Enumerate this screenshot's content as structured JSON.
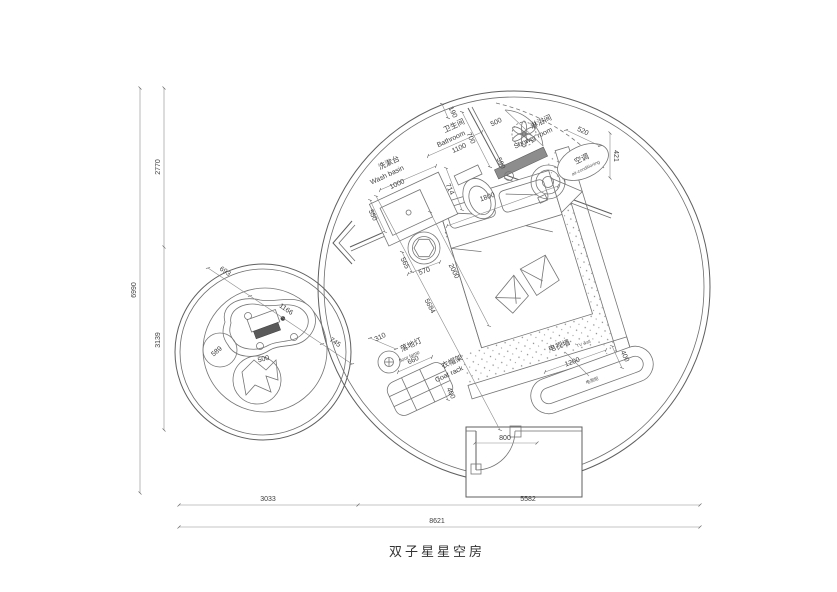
{
  "title": "双子星星空房",
  "dims": {
    "total_height": "6990",
    "upper_height": "2770",
    "lower_height": "3139",
    "left_width": "3033",
    "right_width": "5582",
    "total_width": "8621",
    "door": "800",
    "diag": "5684",
    "top_small": "190",
    "bath_inner": "700",
    "bath_door": "500",
    "drain": "590"
  },
  "rooms": {
    "bathroom": {
      "zh": "卫生间",
      "en": "Bathroom",
      "width": "1100"
    },
    "shower": {
      "zh": "淋浴间",
      "en": "Shower room",
      "shelf": "520"
    }
  },
  "furniture": {
    "washbasin": {
      "zh": "洗漱台",
      "en": "Wash basin",
      "width": "1000",
      "depth": "550"
    },
    "toilet": {
      "width": "714"
    },
    "ac": {
      "zh": "空调",
      "en": "air-conditioning",
      "depth": "421"
    },
    "bed": {
      "width": "1800",
      "length": "2000"
    },
    "stool": {
      "a": "565",
      "b": "570"
    },
    "floorlamp": {
      "zh": "落地灯",
      "en": "floor lamp",
      "dia": "310"
    },
    "coatrack": {
      "zh": "衣帽架",
      "en": "Coat rack",
      "width": "660",
      "depth": "400"
    },
    "tv": {
      "wall_zh": "电视墙",
      "wall_en": "TV wall",
      "cabinet_zh": "电视柜",
      "width": "1200",
      "depth": "400"
    },
    "table": {
      "seg1": "693",
      "seg2": "1166",
      "seg3": "745"
    },
    "pouf": {
      "dia": "589"
    },
    "beanbag": {
      "dia": "500"
    }
  }
}
